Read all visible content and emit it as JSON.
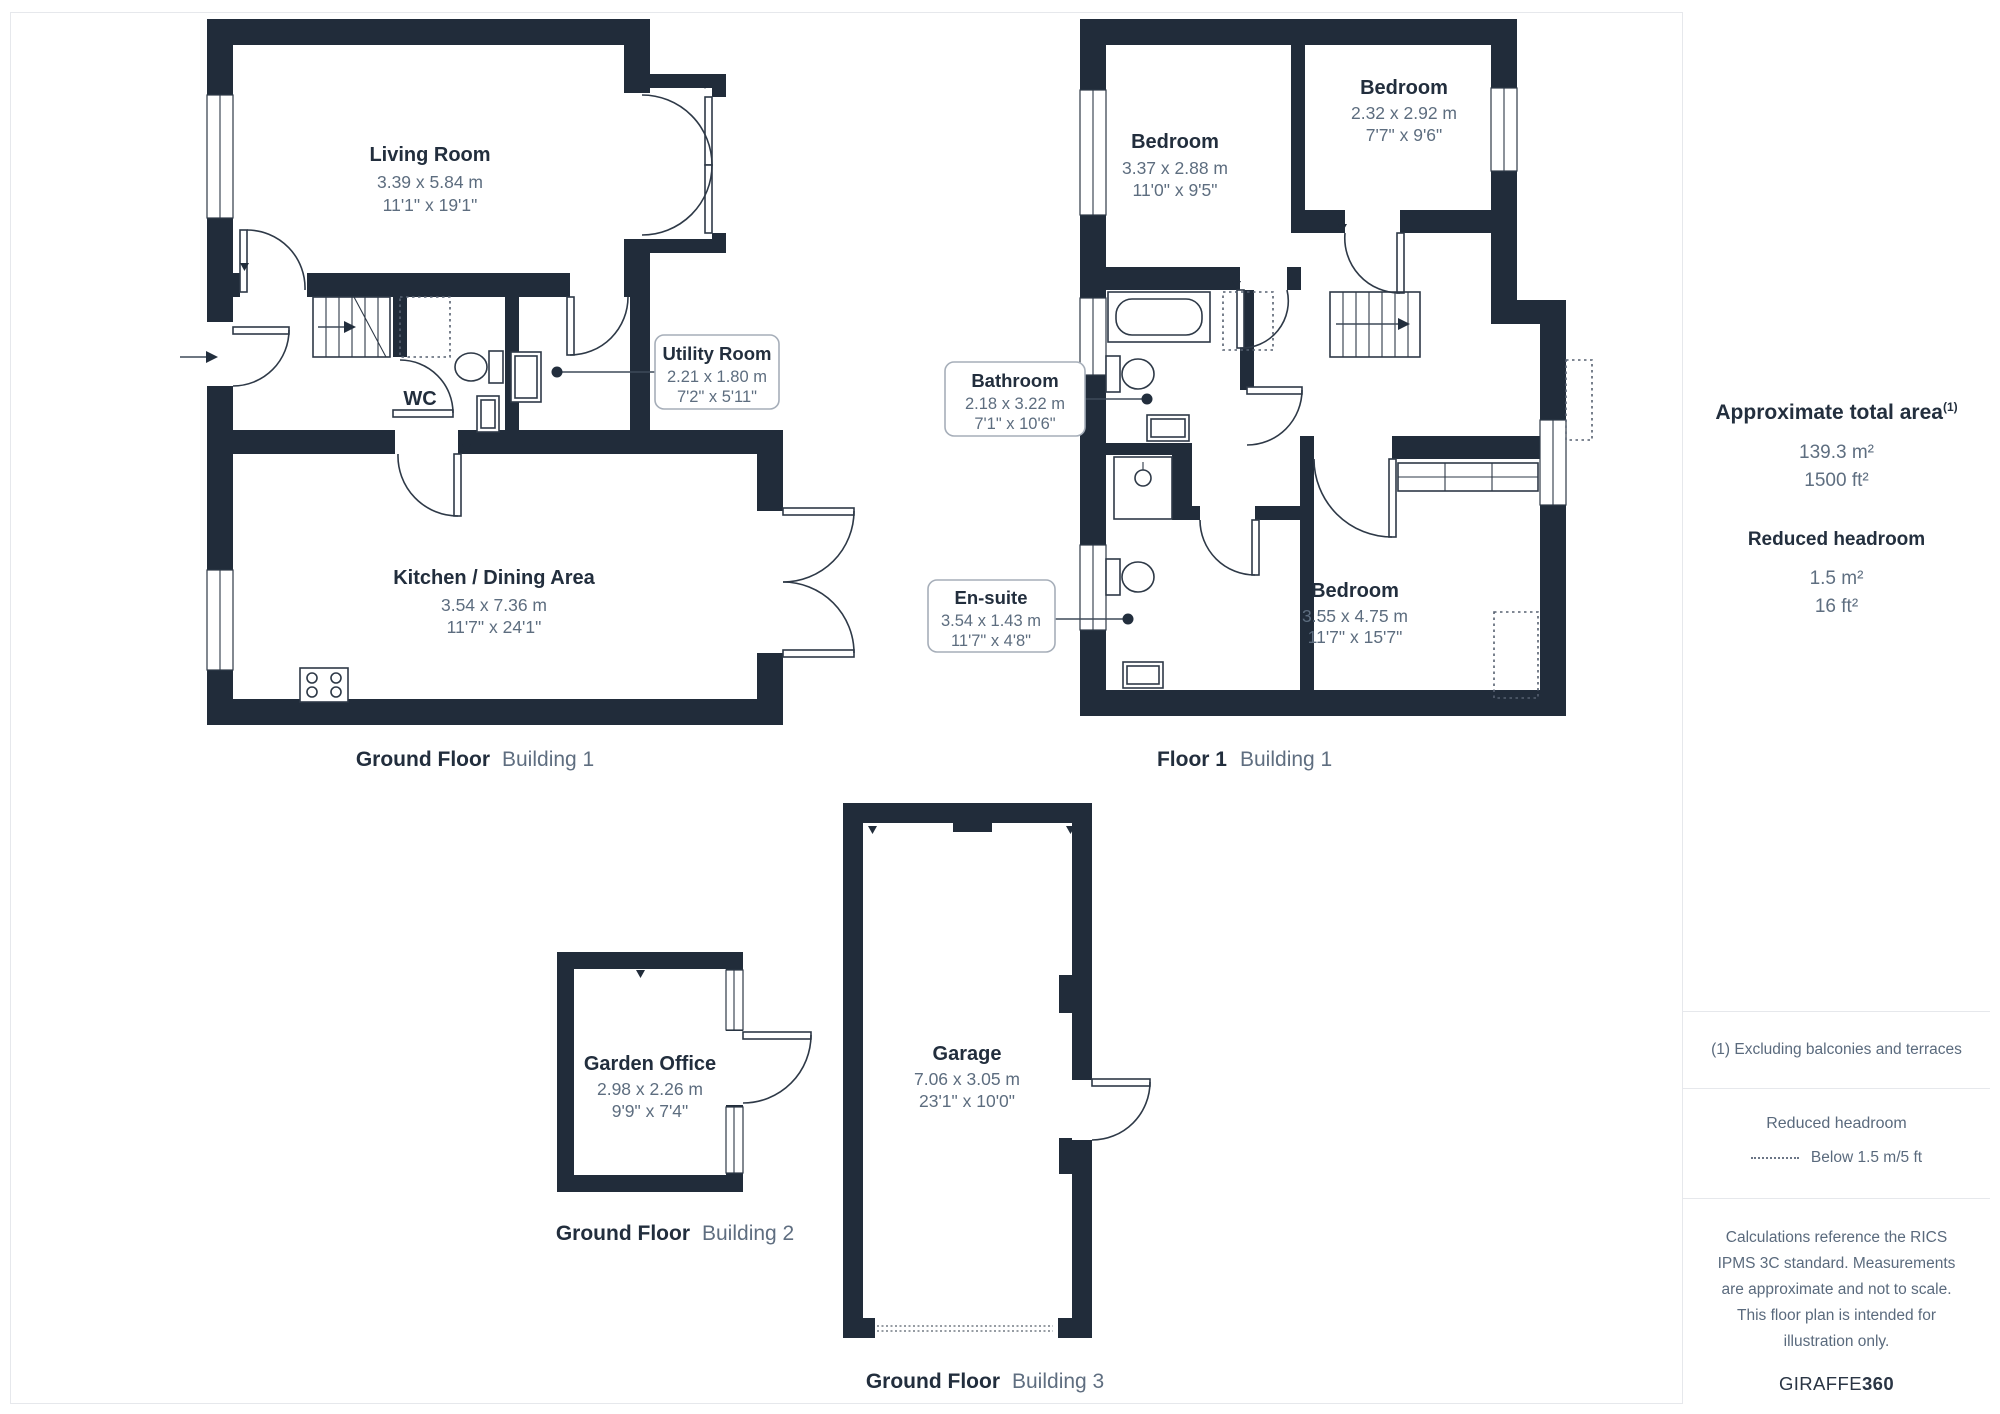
{
  "colors": {
    "wall": "#212c3a",
    "title_text": "#222e3d",
    "dimension_text": "#5d6d7f",
    "thin_line": "#2e3947",
    "divider": "#e6e8ec"
  },
  "plans": {
    "ground_floor_b1": {
      "caption_bold": "Ground Floor",
      "caption_light": "Building 1",
      "rooms": {
        "living_room": {
          "name": "Living Room",
          "metric": "3.39 x 5.84 m",
          "imperial": "11'1\" x 19'1\""
        },
        "wc": {
          "name": "WC"
        },
        "kitchen": {
          "name": "Kitchen / Dining Area",
          "metric": "3.54 x 7.36 m",
          "imperial": "11'7\" x 24'1\""
        },
        "utility": {
          "name": "Utility Room",
          "metric": "2.21 x 1.80 m",
          "imperial": "7'2\" x 5'11\""
        }
      }
    },
    "floor1_b1": {
      "caption_bold": "Floor 1",
      "caption_light": "Building 1",
      "rooms": {
        "bedroom_a": {
          "name": "Bedroom",
          "metric": "3.37 x 2.88 m",
          "imperial": "11'0\" x 9'5\""
        },
        "bedroom_b": {
          "name": "Bedroom",
          "metric": "2.32 x 2.92 m",
          "imperial": "7'7\" x 9'6\""
        },
        "bathroom": {
          "name": "Bathroom",
          "metric": "2.18 x 3.22 m",
          "imperial": "7'1\" x 10'6\""
        },
        "ensuite": {
          "name": "En-suite",
          "metric": "3.54 x 1.43 m",
          "imperial": "11'7\" x 4'8\""
        },
        "bedroom_c": {
          "name": "Bedroom",
          "metric": "3.55 x 4.75 m",
          "imperial": "11'7\" x 15'7\""
        }
      }
    },
    "ground_floor_b2": {
      "caption_bold": "Ground Floor",
      "caption_light": "Building 2",
      "rooms": {
        "garden_office": {
          "name": "Garden Office",
          "metric": "2.98 x 2.26 m",
          "imperial": "9'9\" x 7'4\""
        }
      }
    },
    "ground_floor_b3": {
      "caption_bold": "Ground Floor",
      "caption_light": "Building 3",
      "rooms": {
        "garage": {
          "name": "Garage",
          "metric": "7.06 x 3.05 m",
          "imperial": "23'1\" x 10'0\""
        }
      }
    }
  },
  "sidebar": {
    "total_area": {
      "title": "Approximate total area",
      "superscript": "(1)",
      "metric": "139.3 m²",
      "imperial": "1500 ft²"
    },
    "reduced_headroom": {
      "title": "Reduced headroom",
      "metric": "1.5 m²",
      "imperial": "16 ft²"
    },
    "footnote": "(1) Excluding balconies and terraces",
    "legend": {
      "title": "Reduced headroom",
      "label": "Below 1.5 m/5 ft"
    },
    "disclaimer": "Calculations reference the RICS IPMS 3C standard. Measurements are approximate and not to scale. This floor plan is intended for illustration only.",
    "brand": {
      "regular": "GIRAFFE",
      "bold": "360"
    }
  }
}
